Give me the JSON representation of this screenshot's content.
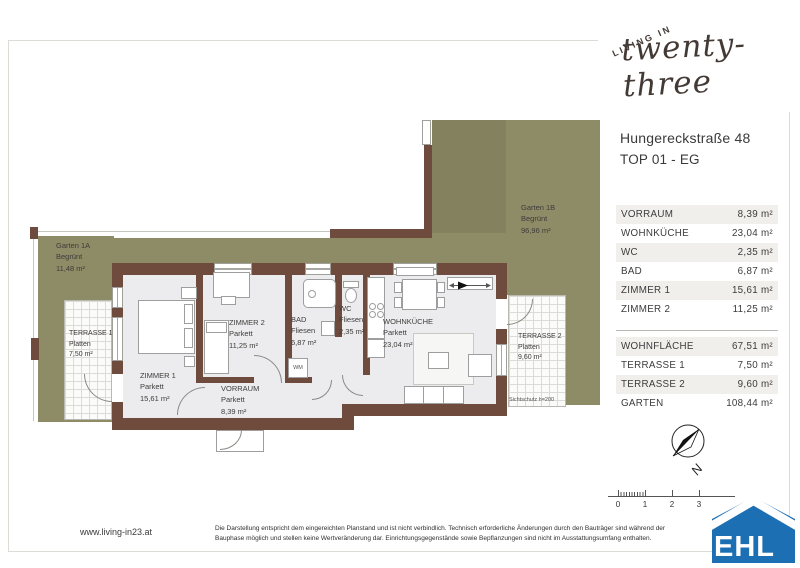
{
  "brand": {
    "tagline": "LIVING IN",
    "name": "twenty-three"
  },
  "header": {
    "address": "Hungereckstraße 48",
    "unit": "TOP 01 - EG"
  },
  "room_table": [
    {
      "label": "VORRAUM",
      "value": "8,39 m²"
    },
    {
      "label": "WOHNKÜCHE",
      "value": "23,04 m²"
    },
    {
      "label": "WC",
      "value": "2,35 m²"
    },
    {
      "label": "BAD",
      "value": "6,87 m²"
    },
    {
      "label": "ZIMMER 1",
      "value": "15,61 m²"
    },
    {
      "label": "ZIMMER 2",
      "value": "11,25 m²"
    }
  ],
  "summary_table": [
    {
      "label": "WOHNFLÄCHE",
      "value": "67,51 m²"
    },
    {
      "label": "TERRASSE 1",
      "value": "7,50 m²"
    },
    {
      "label": "TERRASSE 2",
      "value": "9,60 m²"
    },
    {
      "label": "GARTEN",
      "value": "108,44 m²"
    }
  ],
  "plan": {
    "garten1a": {
      "name": "Garten 1A",
      "finish": "Begrünt",
      "area": "11,48 m²"
    },
    "garten1b": {
      "name": "Garten 1B",
      "finish": "Begrünt",
      "area": "96,96 m²"
    },
    "terrasse1": {
      "name": "TERRASSE 1",
      "finish": "Platten",
      "area": "7,50 m²"
    },
    "terrasse2": {
      "name": "TERRASSE 2",
      "finish": "Platten",
      "area": "9,60 m²"
    },
    "zimmer1": {
      "name": "ZIMMER 1",
      "finish": "Parkett",
      "area": "15,61 m²"
    },
    "zimmer2": {
      "name": "ZIMMER 2",
      "finish": "Parkett",
      "area": "11,25 m²"
    },
    "bad": {
      "name": "BAD",
      "finish": "Fliesen",
      "area": "6,87 m²"
    },
    "wc": {
      "name": "WC",
      "finish": "Fliesen",
      "area": "2,35 m²"
    },
    "wohnkueche": {
      "name": "WOHNKÜCHE",
      "finish": "Parkett",
      "area": "23,04 m²"
    },
    "vorraum": {
      "name": "VORRAUM",
      "finish": "Parkett",
      "area": "8,39 m²"
    },
    "washer_label": "WM",
    "privacy_note": "Sichtschutz h=200",
    "compass_label": "N",
    "scale_ticks": [
      "0",
      "1",
      "2",
      "3"
    ]
  },
  "footer": {
    "website": "www.living-in23.at",
    "disclaimer_line1": "Die Darstellung entspricht dem eingereichten Planstand und ist nicht verbindlich. Technisch erforderliche Änderungen durch den Bauträger sind während der",
    "disclaimer_line2": "Bauphase möglich und stellen keine Wertveränderung dar. Einrichtungsgegenstände sowie Bepflanzungen sind nicht im Ausstattungsumfang enthalten.",
    "partner_logo": "EHL"
  },
  "colors": {
    "garden": "#8e8b67",
    "wall": "#6f4b3d",
    "floor": "#ececee",
    "ehl_blue": "#1d6fb4",
    "row_shade": "#f0efec"
  }
}
